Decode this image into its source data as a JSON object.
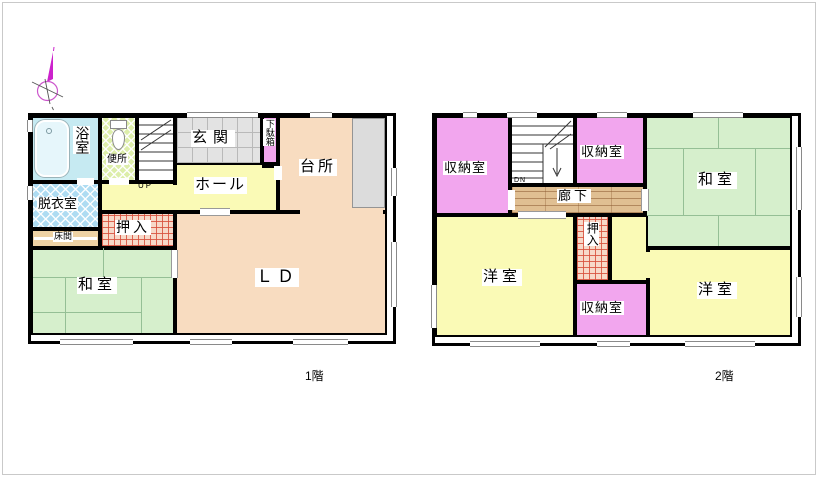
{
  "compass": {
    "icon": "north-compass",
    "color": "#cc22cc"
  },
  "floor1": {
    "caption": "1階",
    "rooms": {
      "bath": "浴室",
      "toilet": "便所",
      "entrance": "玄関",
      "shoe_cabinet": "下駄箱",
      "kitchen": "台所",
      "hall": "ホール",
      "dressing": "脱衣室",
      "tokonoma": "床間",
      "closet": "押入",
      "washitsu": "和室",
      "living_dining": "ＬＤ",
      "stairs_up": "UP"
    }
  },
  "floor2": {
    "caption": "2階",
    "rooms": {
      "storage_left": "収納室",
      "storage_top": "収納室",
      "storage_bottom": "収納室",
      "washitsu": "和室",
      "corridor": "廊下",
      "closet": "押入",
      "western_left": "洋室",
      "western_right": "洋室",
      "stairs_down": "DN"
    }
  },
  "colors": {
    "wall": "#000000",
    "ld_kitchen": "#f8dcc0",
    "hall_western": "#fafab6",
    "tatami": "#d6efcc",
    "storage_pink": "#f2a6ee",
    "bath_blue": "#c6eaf2",
    "dressing_hatch": "#aedcf2",
    "toilet_hatch": "#ddeeaa",
    "closet_grid": "#f7d9c9",
    "entrance_tile": "#e3e3e3",
    "corridor_plank": "#e0bf92",
    "tokonoma": "#eed2a4",
    "counter": "#dcdcdc",
    "window_line": "#8a8a8a",
    "compass": "#cc22cc"
  }
}
